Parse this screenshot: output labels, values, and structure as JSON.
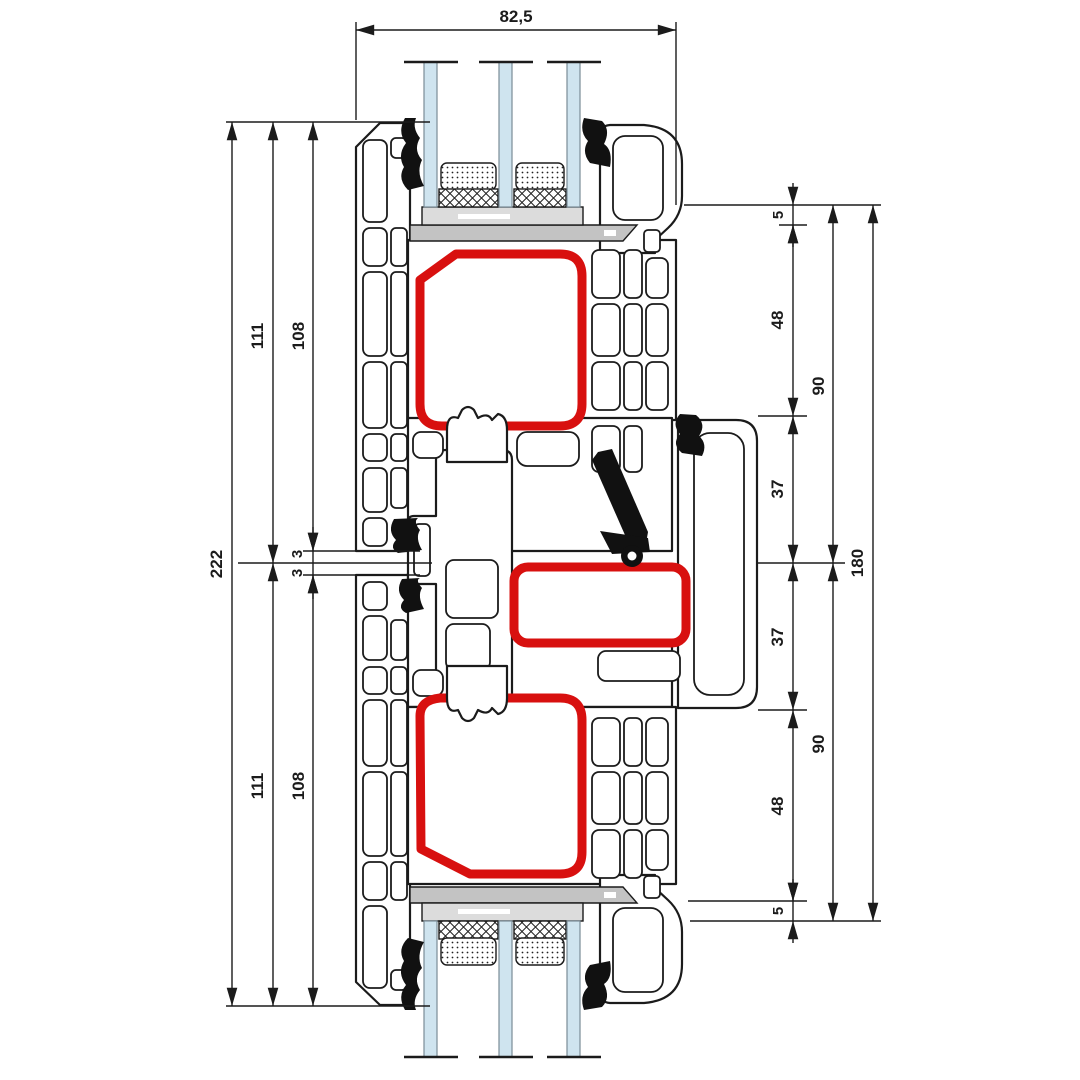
{
  "drawing": {
    "type": "window-profile-section",
    "description": "PVC window meeting-stile cross section with triple glazing and steel reinforcement chambers",
    "colors": {
      "background": "#ffffff",
      "line": "#1b1b1b",
      "steel_chamber_red": "#d8100f",
      "glass_blue": "#cfe4ef",
      "packer_light_gray": "#dcdcdc",
      "packer_dark_gray": "#c3c3c3"
    },
    "dims": {
      "top_width": "82,5",
      "left": [
        "222",
        "111",
        "108",
        "3",
        "3",
        "111",
        "108"
      ],
      "right": [
        "5",
        "48",
        "90",
        "37",
        "180",
        "37",
        "90",
        "48",
        "5"
      ]
    }
  }
}
